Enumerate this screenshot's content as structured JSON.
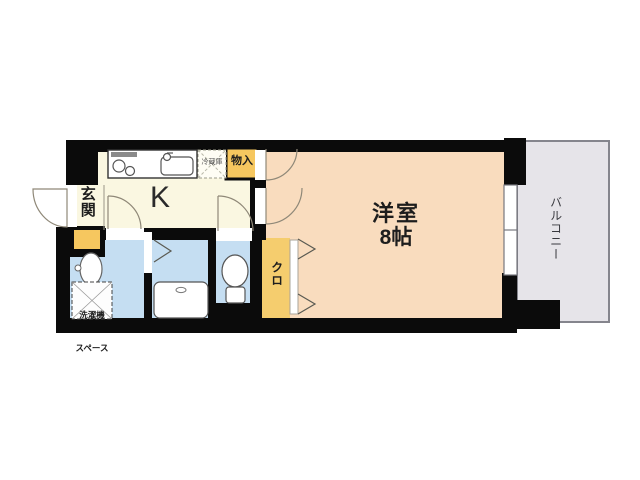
{
  "plan": {
    "kitchen_label": "K",
    "main_room_label": "洋室",
    "main_room_size": "8帖",
    "balcony_label": "バルコニー",
    "entrance_label": "玄関",
    "closet_label": "クロ",
    "storage_label": "物入",
    "refrigerator_label": "冷蔵庫",
    "washer_space_line1": "洗濯機",
    "washer_space_line2": "スペース",
    "colors": {
      "wall": "#0b0b0b",
      "kitchen_floor": "#FAF7E1",
      "main_room_floor": "#F9DCBE",
      "wet_area_floor": "#C5DEF2",
      "closet_floor": "#F5CD6E",
      "storage_fill": "#F6C75F",
      "balcony_floor": "#E6E4E9",
      "door_line": "#8f8878"
    }
  }
}
